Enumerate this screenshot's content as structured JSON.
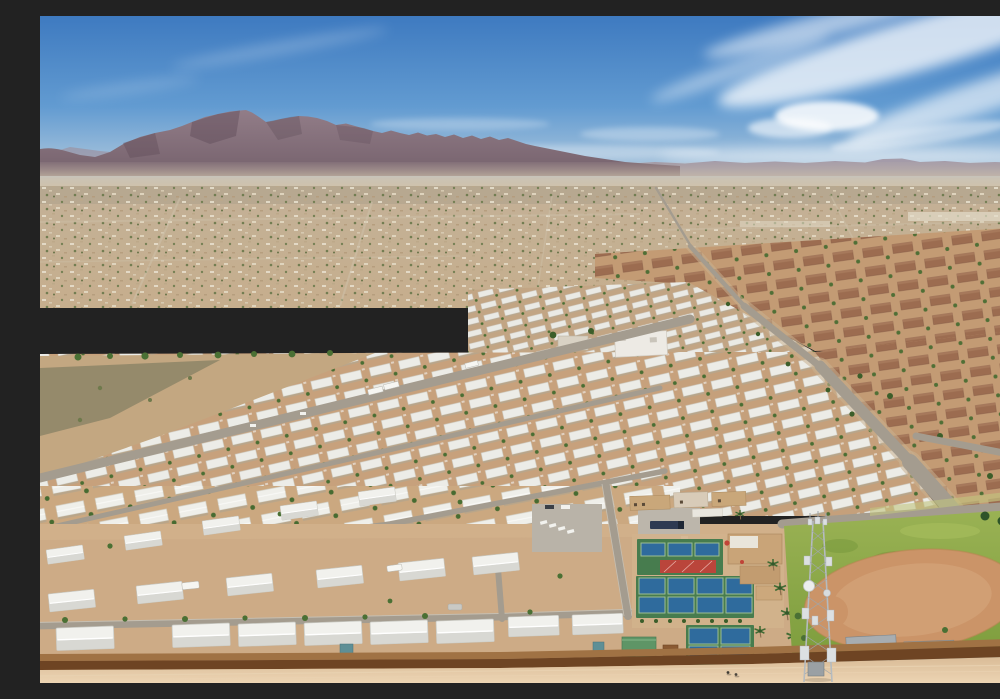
{
  "meta": {
    "type": "aerial-photograph",
    "description": "Aerial drone view of a sprawling desert mobile home park community with rows of white-roofed homes, pickleball courts with a red shade canopy, a softball field with dirt infield, a lattice cell tower, a brown perimeter wall with a dirt track, distant suburban sprawl, and a rugged mountain range under a blue sky with wispy cirrus clouds."
  },
  "colors": {
    "sky_top": "#3E7AC0",
    "sky_mid": "#629BD1",
    "sky_low": "#A8C4DC",
    "sky_horizon": "#D5DFE6",
    "cloud": "#FFFFFF",
    "mountain_top": "#927D88",
    "mountain_base": "#75616C",
    "distant_ridge": "#9C8C98",
    "haze": "#CDBFA9",
    "sprawl_top": "#C3B197",
    "sprawl_bottom": "#C6AE8D",
    "roof_white": "#F1F1ED",
    "park_dirt": "#C7A17C",
    "street_gray": "#A49C8F",
    "brown_roof": "#9A6A4E",
    "subdivision_dirt": "#C39B74",
    "court_green": "#477C4E",
    "court_blue": "#2F6B9D",
    "canopy_red": "#BA453B",
    "grass_light": "#9AB254",
    "grass_dark": "#7E9E3E",
    "infield_dirt": "#CB9468",
    "wall_top": "#A07244",
    "wall_face": "#6E4423",
    "foreground_dirt": "#CDAB86",
    "bottom_dirt": "#D9BB96",
    "tower_steel": "#B5BBBF",
    "tree_green": "#4A7034"
  },
  "scene": {
    "sky": {
      "label": "blue sky with cirrus clouds"
    },
    "mountains": {
      "label": "desert mountain range on horizon"
    },
    "sprawl": {
      "label": "hazy distant suburban sprawl"
    },
    "mobile_home_park": {
      "label": "mobile home park with rows of white roofs"
    },
    "brown_subdivision": {
      "label": "single-family subdivision with brown roofs"
    },
    "main_road": {
      "label": "main road curving through community"
    },
    "amenities": {
      "pickleball_courts": {
        "label": "pickleball court complex",
        "upper_court_count": 6,
        "middle_court_count": 8,
        "lower_court_count": 4,
        "canopy": "red shade canopy"
      },
      "softball_field": {
        "label": "softball field with dirt infield and green outfield"
      },
      "cell_tower": {
        "label": "lattice telecommunications tower with dish antennas"
      },
      "parking_lot": {
        "label": "parking lots with cars and trucks"
      },
      "clubhouse": {
        "label": "tan clubhouse and storage buildings"
      },
      "green_roof_building": {
        "label": "small green-roofed utility building"
      }
    },
    "perimeter_wall": {
      "label": "brown perimeter block wall"
    },
    "dirt_track": {
      "label": "light tan dirt strip along wall"
    },
    "pedestrians": {
      "count": 2
    },
    "vehicles": {
      "label": "RVs, campers, trucks and cars parked throughout"
    }
  }
}
